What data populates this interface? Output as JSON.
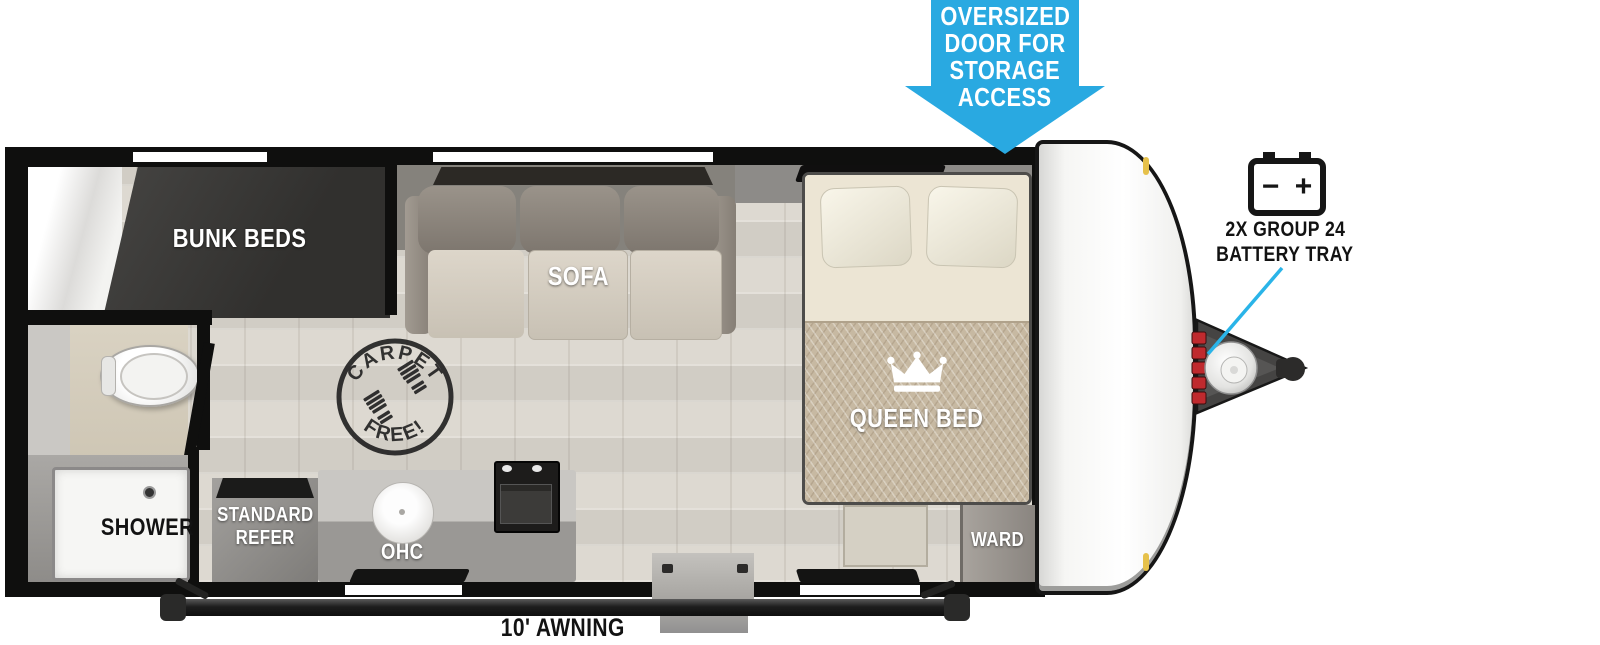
{
  "callout": {
    "lines": [
      "OVERSIZED",
      "DOOR FOR",
      "STORAGE",
      "ACCESS"
    ],
    "color": "#29a9e1"
  },
  "battery_tray": {
    "minus": "−",
    "plus": "+",
    "label_lines": [
      "2X GROUP 24",
      "BATTERY TRAY"
    ],
    "leader_color": "#2ab4e8"
  },
  "labels": {
    "bunk_beds": "BUNK BEDS",
    "sofa_ohc": "OHC",
    "sofa": "SOFA",
    "queen_bed": "QUEEN BED",
    "ward": "WARD",
    "shower": "SHOWER",
    "refer_lines": [
      "STANDARD",
      "REFER"
    ],
    "kitchen_ohc": "OHC",
    "awning": "10' AWNING"
  },
  "stamp": {
    "arc_top": "CARPET",
    "arc_bottom": "FREE!"
  },
  "colors": {
    "callout_blue": "#29a9e1",
    "wall_black": "#0f0f0e",
    "floor": "#d8d4cc",
    "bunk_mattress": "#3a3938",
    "sofa_back": "#8f887e",
    "sofa_seat": "#d8d1c5",
    "bed_sheet": "#ece5d4",
    "bed_blanket": "#c7b9a2",
    "battery_red": "#bf2a2e",
    "stamp_ink": "#1f1f1f"
  }
}
